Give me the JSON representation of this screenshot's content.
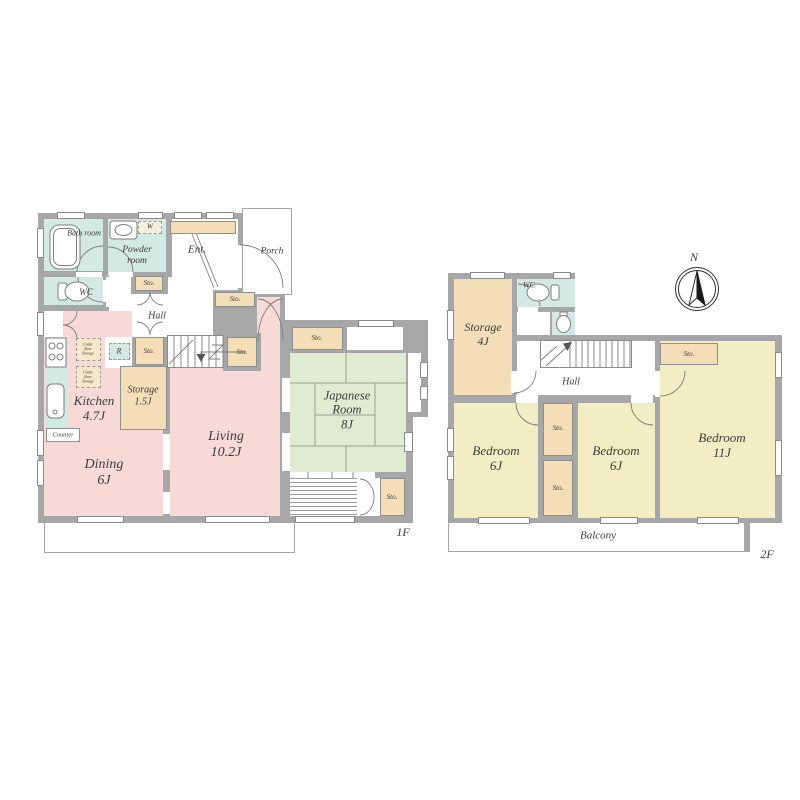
{
  "colors": {
    "wall": "#a7a7a7",
    "room_pink": "#f7dad6",
    "room_teal": "#d3eae4",
    "room_beige": "#f3deb8",
    "room_green": "#e0ecd1",
    "room_yellow": "#f4ecc3"
  },
  "shared": {
    "sto": "Sto."
  },
  "floor1": {
    "tag": "1F",
    "bath": "Bath room",
    "powder": "Powder room",
    "wc": "WC",
    "ent": "Ent.",
    "porch": "Porch",
    "hall": "Hall",
    "counter": "Counter",
    "washer": "W",
    "fridge": "R",
    "underfloor": "Under floor Storage",
    "kitchen": {
      "name": "Kitchen",
      "area": "4.7J"
    },
    "storage": {
      "name": "Storage",
      "area": "1.5J"
    },
    "living": {
      "name": "Living",
      "area": "10.2J"
    },
    "dining": {
      "name": "Dining",
      "area": "6J"
    },
    "japanese_room": {
      "name": "Japanese Room",
      "area": "8J"
    }
  },
  "floor2": {
    "tag": "2F",
    "wc": "WC",
    "hall": "Hall",
    "balcony": "Balcony",
    "north": "N",
    "storage": {
      "name": "Storage",
      "area": "4J"
    },
    "bedroom_left": {
      "name": "Bedroom",
      "area": "6J"
    },
    "bedroom_center": {
      "name": "Bedroom",
      "area": "6J"
    },
    "bedroom_right": {
      "name": "Bedroom",
      "area": "11J"
    }
  }
}
